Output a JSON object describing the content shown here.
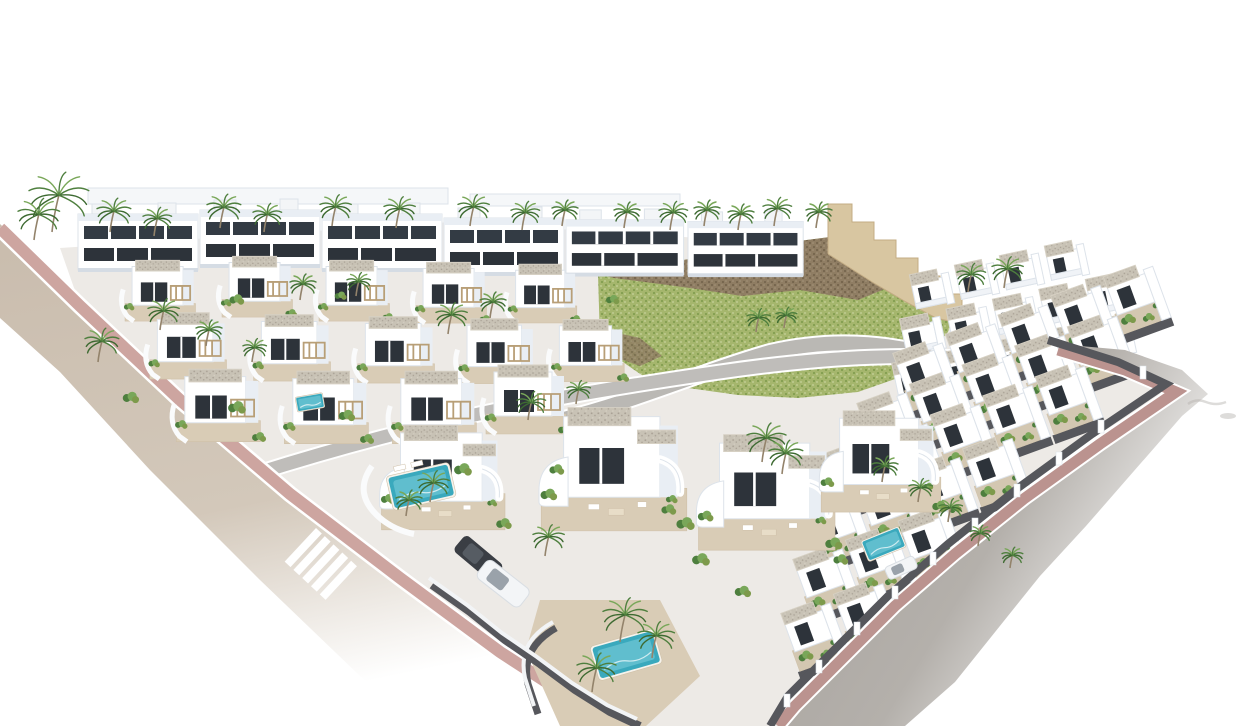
{
  "meta": {
    "type": "3d-architectural-render",
    "alt": "Aerial three-quarter render of a modern residential development of white cubic villas and terraced houses with flat gravel roofs, dark window openings, palm trees, turquoise pools, a green rocky hillside with a stepped sand retaining wall, a sand-coloured road with dashed line and zebra crossing on the left, and a grey boulevard with rose paver sidewalk wrapping the right side, on a pure white background"
  },
  "palette": {
    "bg": "#ffffff",
    "road-tan": "#c9bcad",
    "road-tan-light": "#d3c8ba",
    "road-gray": "#a39e99",
    "road-gray-light": "#b4b0ab",
    "sidewalk-pink": "#cda5a0",
    "sidewalk-pink-dark": "#bb938f",
    "curb-white": "#ffffff",
    "wall-dark": "#56575c",
    "villa-white": "#ffffff",
    "villa-shade": "#e9eef4",
    "villa-shade-deep": "#d5dce4",
    "villa-line": "#dde3ea",
    "window-dark": "#2d333a",
    "gravel": "#c8c2b5",
    "gravel-dot": "#a8a094",
    "gravel-edge": "#d6d0c3",
    "terrace-tan": "#d9ccb6",
    "terrace-edge": "#cfc0a8",
    "hill-green": "#a5b66d",
    "hill-green-dark": "#7d9a4b",
    "hill-green-light": "#c6d19b",
    "rock-brown": "#8e7a62",
    "rock-brown-dark": "#6e5c48",
    "step-wall-sand": "#d8c6a1",
    "step-wall-sand-dark": "#c3ac84",
    "palm-green": "#4e7f3e",
    "palm-green-dark": "#3d6a31",
    "palm-green-light": "#79a759",
    "palm-trunk": "#93836b",
    "pool-teal": "#3aa9bd",
    "pool-teal-light": "#7fd0dc",
    "pergola-wood": "#b89f77",
    "car-dark": "#3a3e44",
    "car-white": "#f3f5f7",
    "car-glass": "#9aa2aa",
    "ghost-gray": "#b6b2ae"
  },
  "scene": {
    "background": "plain white, no sky gradient",
    "hill": {
      "cover": "green scrub with light speckle",
      "ridge": "brown rocky crag band along the top",
      "retaining_wall": "stepped sand-coloured wall descending to the right",
      "access_road": "grey curve at the foot of the hill"
    },
    "roads": [
      {
        "id": "left-road",
        "surface": "sand/tan asphalt",
        "markings": [
          "white dashed centre line at top-left",
          "white zebra crosswalk mid-way"
        ],
        "sidewalk": "rose pavers with white curb",
        "direction": "enters top-left, sweeps to bottom centre, fades to white"
      },
      {
        "id": "right-road",
        "surface": "grey asphalt",
        "markings": [],
        "sidewalk": "rose pavers with white curb and dark boundary wall with white piers",
        "direction": "wraps the right edge of the estate, fades to white at right"
      }
    ],
    "buildings": {
      "back_row_two_storey_villas": 6,
      "mid_detached_villas": 12,
      "front_large_villas": 4,
      "right_terraced_rows": 6,
      "top_right_townhouse_rows": 4,
      "style": "white cubes, dark anthracite glazing, gravel flat roofs, curved white balconies and garden walls, wooden pergolas"
    },
    "features": {
      "pools": 5,
      "palm_trees": 38,
      "parked_cars": [
        {
          "color": "dark grey SUV",
          "location": "driveway left of centre"
        },
        {
          "color": "white SUV",
          "location": "driveway left of centre"
        },
        {
          "color": "white car",
          "location": "right cluster"
        }
      ],
      "faint_marks": "two pale grey squiggles right of the road, far right edge"
    }
  }
}
